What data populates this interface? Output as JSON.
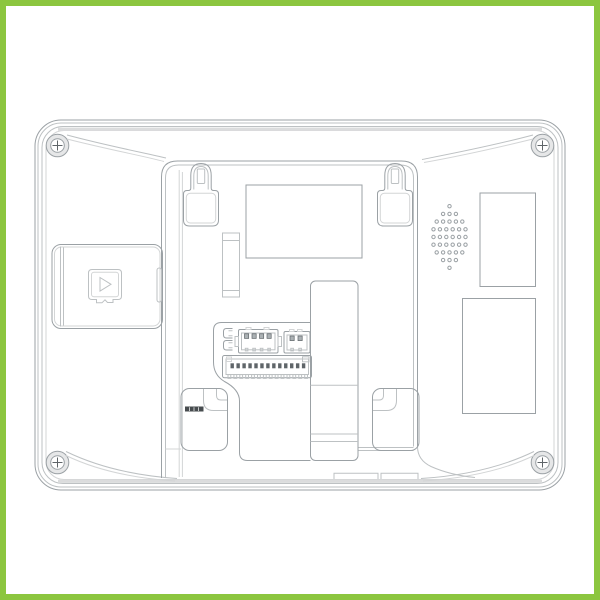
{
  "figure": {
    "description": "Rear view technical line drawing of an indoor monitor device inside a green product frame",
    "style": "CAD outline drawing, no text labels"
  },
  "frame": {
    "color": "#8cc63f",
    "thickness_px": 6
  },
  "colors": {
    "background": "#ffffff",
    "frame": "#8cc63f",
    "line_med": "#9ba1a5",
    "line_light": "#bdc1c3",
    "line_xlight": "#d3d5d6",
    "line_dark": "#5f6569",
    "band": "#dbdcdd",
    "screw_fill": "#e6e7e8",
    "strip_dark": "#474c4f",
    "pin_light": "#abb1b4",
    "tick_white": "#e9eaea"
  },
  "device": {
    "parts": [
      "outer-shell",
      "corner-screws",
      "wall-mount-recess",
      "keyhole-hook-top-left",
      "keyhole-hook-top-right",
      "hook-slot-bottom-left",
      "hook-slot-bottom-right",
      "sd-card-door",
      "microsd-card-icon",
      "speaker-grille",
      "pcb-window-top",
      "pcb-window-right-top",
      "pcb-window-right-bottom",
      "wire-channel-column",
      "connector-block",
      "bottom-stand-tabs"
    ],
    "screws": {
      "count": 4,
      "type": "phillips-cross"
    },
    "speaker_grille": {
      "rows": [
        1,
        3,
        5,
        6,
        6,
        6,
        5,
        3,
        1
      ]
    },
    "main_connector": {
      "pins": 13,
      "teeth": 14
    },
    "four_pin_connector": {
      "pins": 4,
      "ticks": 4
    },
    "two_pin_connector": {
      "pins": 2,
      "ticks": 2
    },
    "bracket_pins": {
      "count": 2
    }
  }
}
